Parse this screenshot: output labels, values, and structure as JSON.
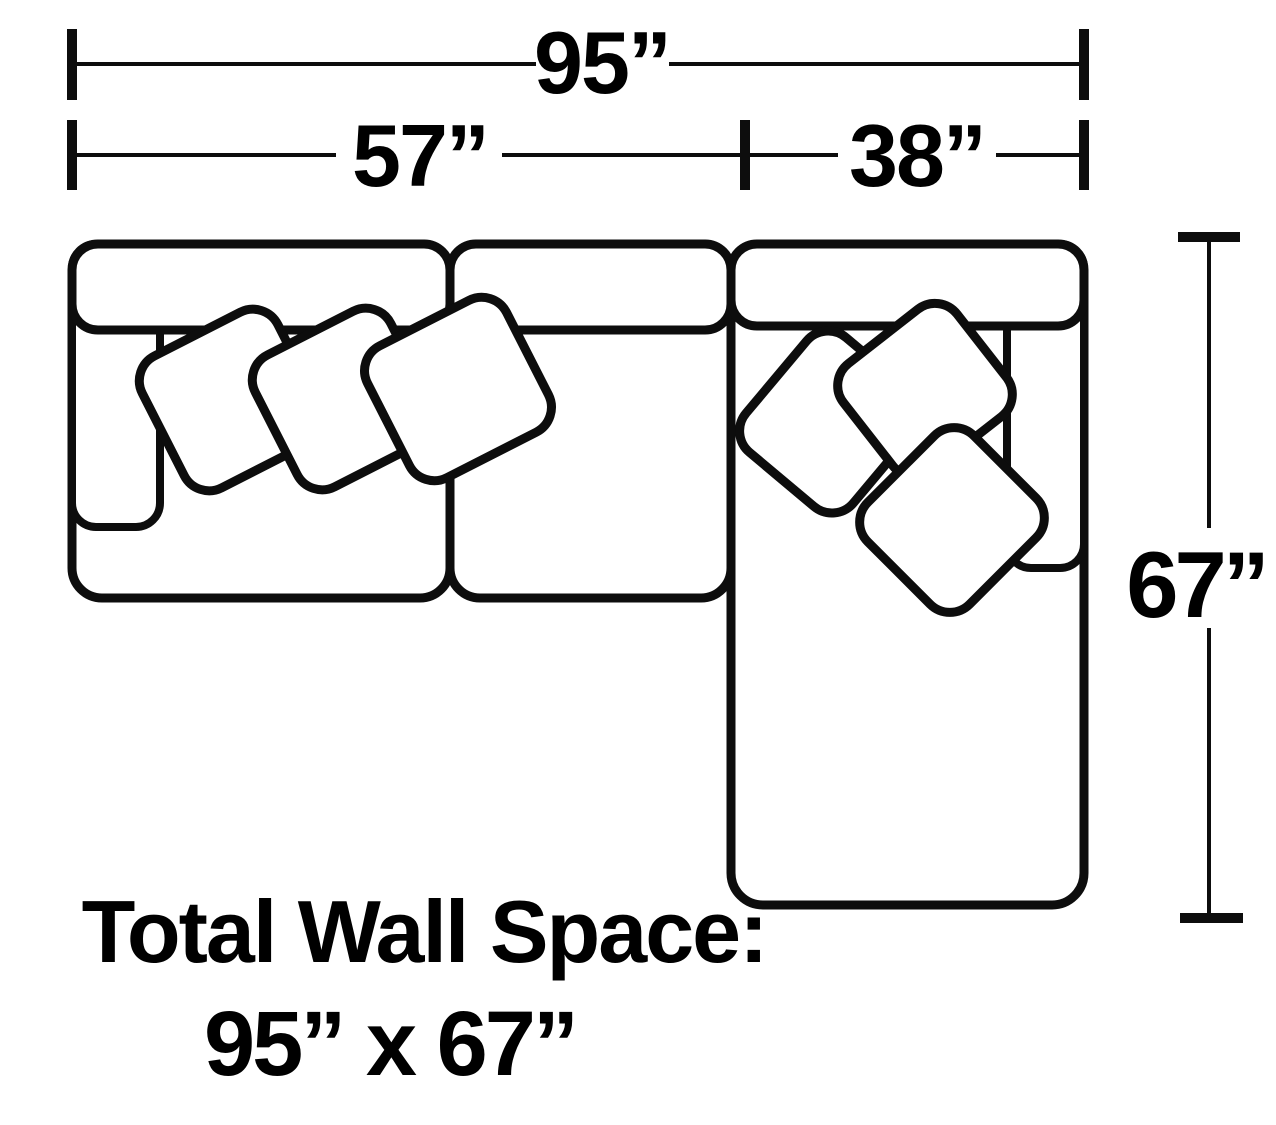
{
  "diagram_type": "sectional-sofa-floor-plan",
  "colors": {
    "background": "#ffffff",
    "line": "#0d0d0d",
    "text": "#000000"
  },
  "dimensions": {
    "total_width": {
      "label": "95”",
      "inches": 95
    },
    "sofa_width": {
      "label": "57”",
      "inches": 57
    },
    "chaise_width": {
      "label": "38”",
      "inches": 38
    },
    "total_depth": {
      "label": "67”",
      "inches": 67
    }
  },
  "caption": {
    "line1": "Total Wall Space:",
    "line2": "95” x 67”"
  },
  "furniture": {
    "pieces": [
      "left-arm seat",
      "armless seat",
      "right-arm chaise"
    ],
    "pillow_count_left": 3,
    "pillow_count_right": 3
  }
}
